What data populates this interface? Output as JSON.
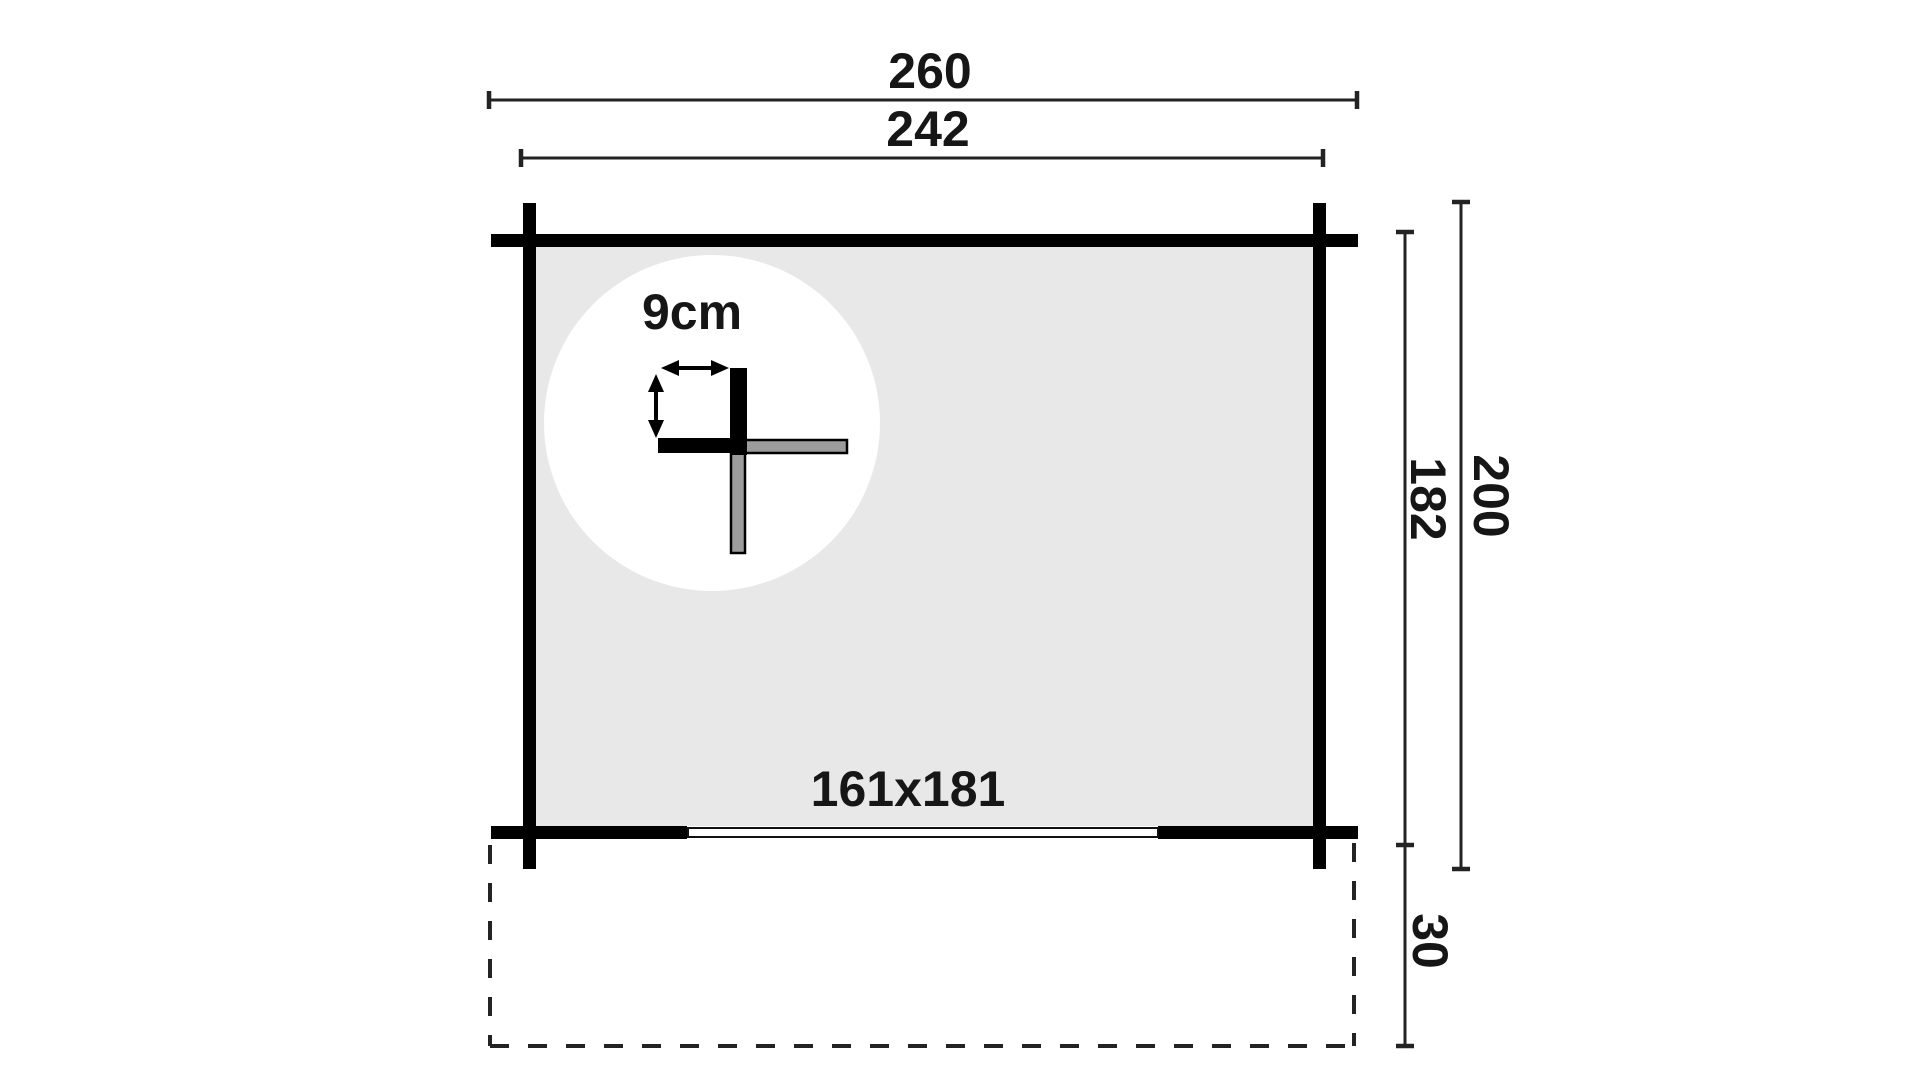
{
  "diagram": {
    "title": "log-cabin-floor-plan",
    "labels": {
      "outer_width": "260",
      "inner_width": "242",
      "wall_thickness": "9cm",
      "door_opening": "161x181",
      "inner_depth": "182",
      "outer_depth": "200",
      "porch_depth": "30"
    },
    "colors": {
      "background": "#ffffff",
      "wall_black": "#000000",
      "interior_gray": "#e9e8e8",
      "door_blue": "#8ed3ec",
      "log_gray": "#9c9c9c",
      "dim_line": "#232323",
      "text": "#161616",
      "detail_circle": "#ffffff"
    }
  }
}
